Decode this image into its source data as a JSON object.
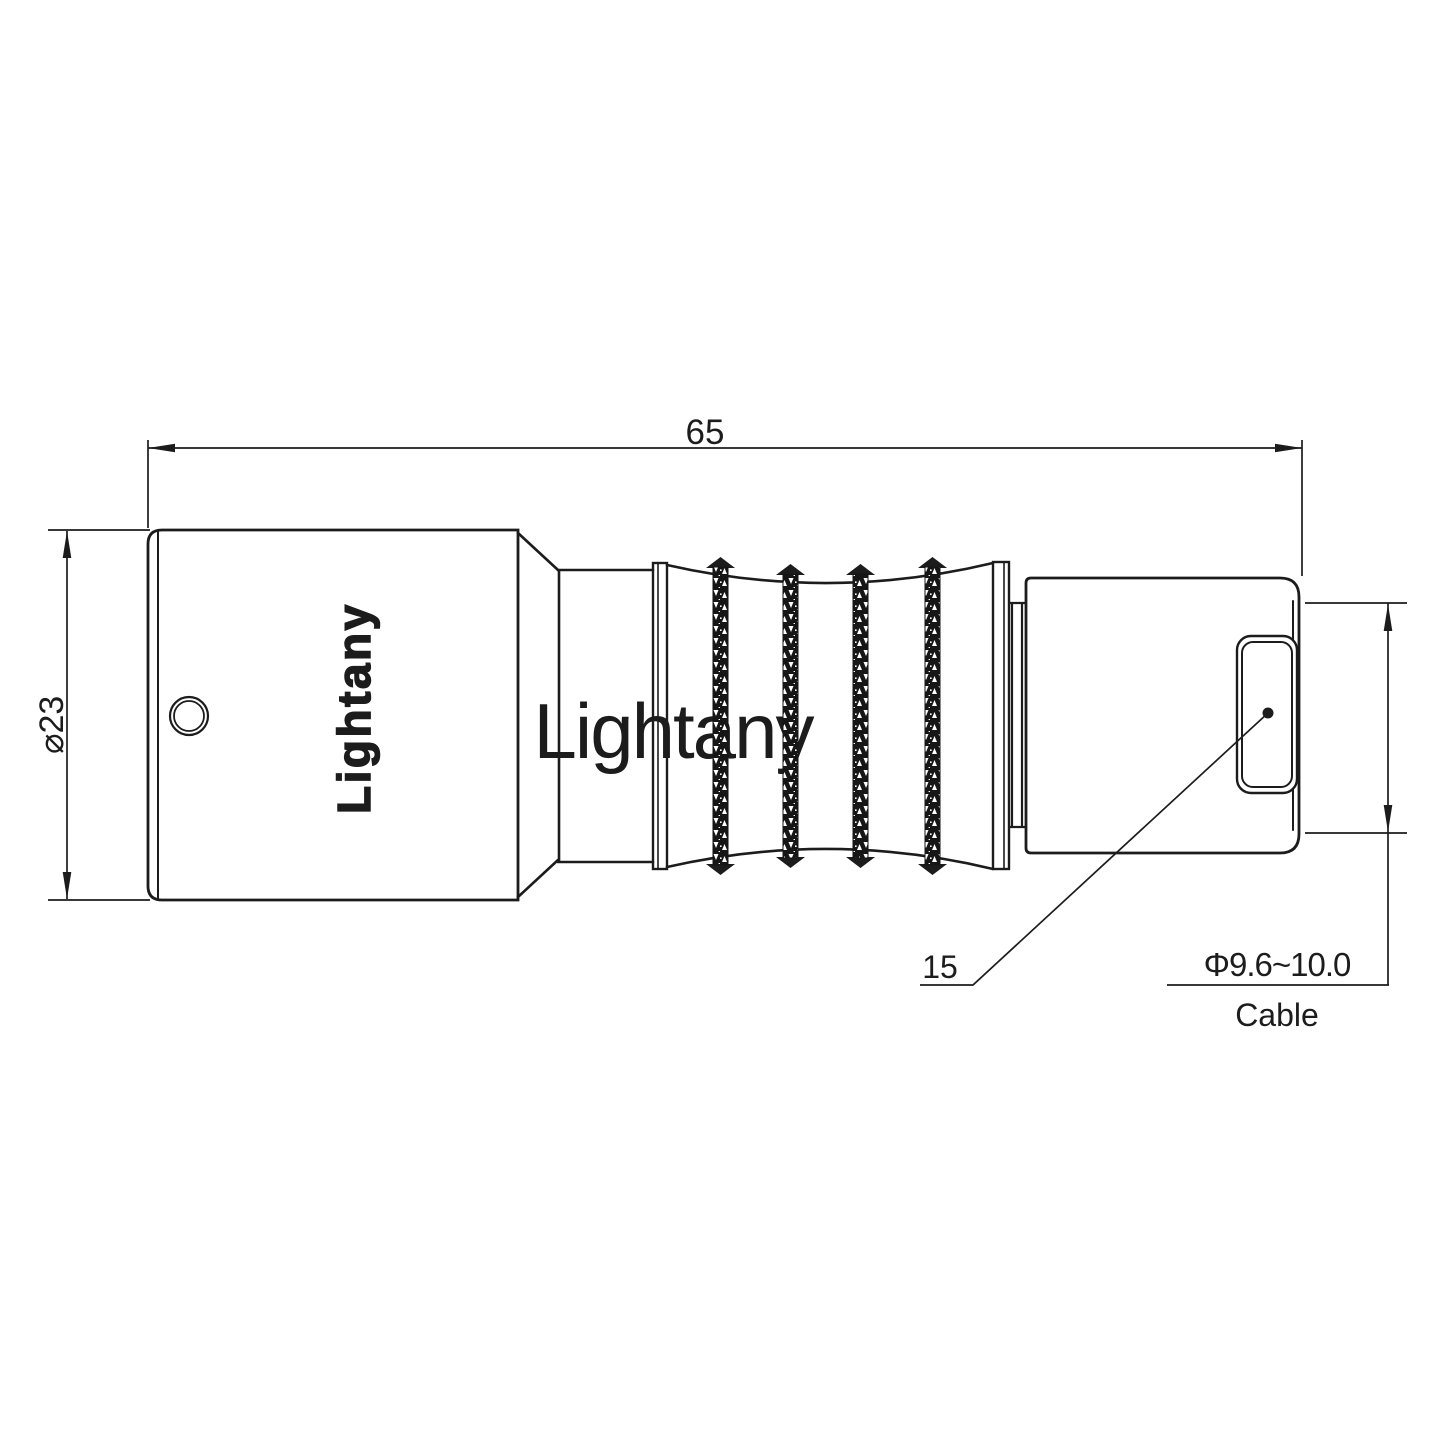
{
  "canvas": {
    "background": "#ffffff",
    "line_color": "#1c1c1c"
  },
  "watermark": {
    "text": "Lightany",
    "color": "#f3d2d2"
  },
  "connector": {
    "brand_text": "Lightany"
  },
  "dimensions": {
    "overall_length": "65",
    "body_diameter": "⌀23",
    "back_length": "15",
    "cable_diameter_range": "Φ9.6~10.0",
    "cable_label": "Cable"
  }
}
